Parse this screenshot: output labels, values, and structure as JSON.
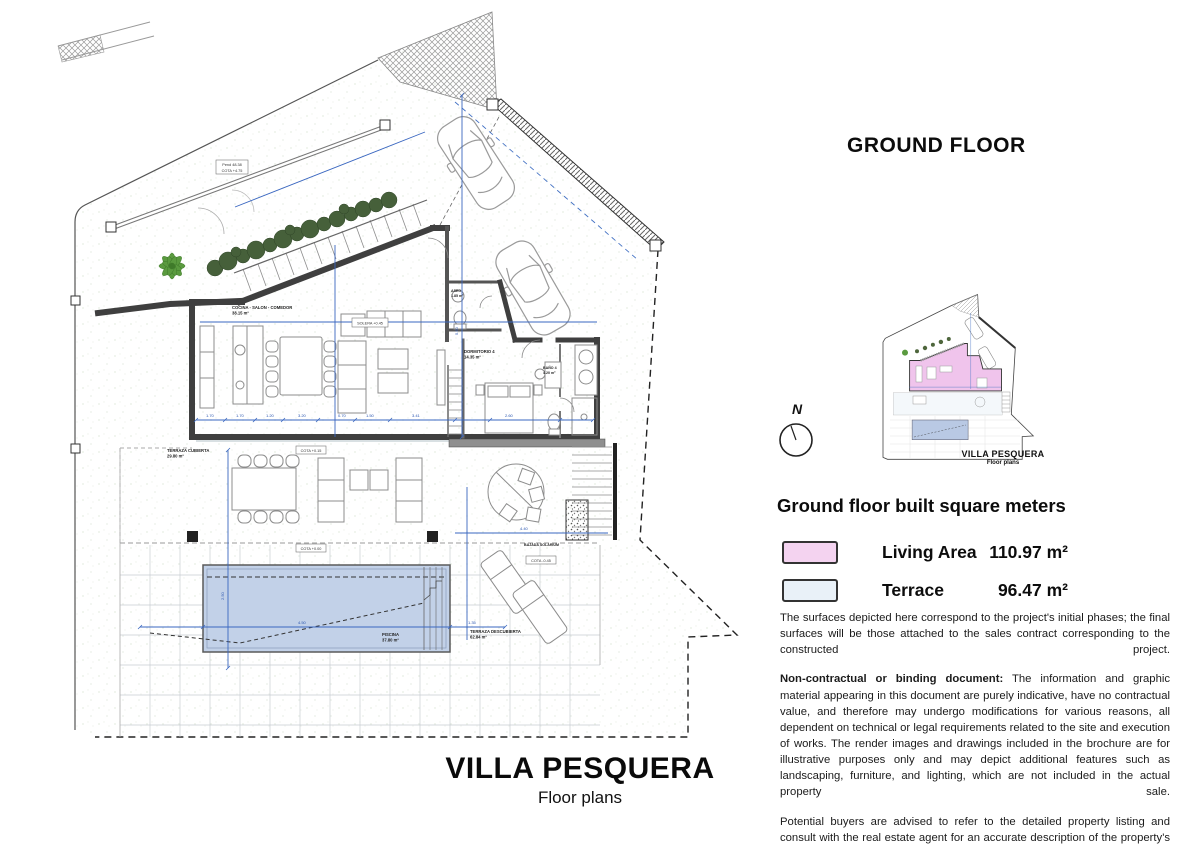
{
  "header": {
    "title": "GROUND FLOOR"
  },
  "inset": {
    "title": "VILLA PESQUERA",
    "subtitle": "Floor plans"
  },
  "compass": {
    "label": "N"
  },
  "legend": {
    "heading": "Ground floor built square meters",
    "items": [
      {
        "label": "Living Area",
        "value": "110.97 m²",
        "color": "#f4d3f0"
      },
      {
        "label": "Terrace",
        "value": "96.47 m²",
        "color": "#e9f1f8"
      }
    ]
  },
  "disclaimer": {
    "p1": "The surfaces depicted here correspond to the project's initial phases; the final surfaces will be those attached to the sales contract corresponding to the constructed project.",
    "p2_lead": "Non-contractual or binding document:",
    "p2_rest": " The information and graphic material appearing in this document are purely indicative, have no contractual value, and therefore may undergo modifications for various reasons, all dependent on technical or legal requirements related to the site and execution of works. The render images and drawings included in the brochure are for illustrative purposes only and may depict additional features such as landscaping, furniture, and lighting, which are not included in the actual property sale.",
    "p3": "Potential buyers are advised to refer to the detailed property listing and consult with the real estate agent for an accurate description of the property's features and inclusions. You may refer to the Decreto 218/2005 Junta de Andalucía, available at our offices."
  },
  "footer": {
    "title": "VILLA PESQUERA",
    "subtitle": "Floor plans"
  },
  "plan": {
    "rooms": {
      "kitchen_living": {
        "name": "COCINA - SALON - COMEDOR",
        "area": "38.15 m²"
      },
      "aseo": {
        "name": "ASEO",
        "area": "1.85 m²"
      },
      "bedroom": {
        "name": "DORMITORIO 4",
        "area": "14.35 m²"
      },
      "bath": {
        "name": "BAÑO 4",
        "area": "4.20 m²"
      },
      "covered_terrace": {
        "name": "TERRAZA CUBIERTA",
        "area": "29.80 m²"
      },
      "open_terrace": {
        "name": "TERRAZA DESCUBIERTA",
        "area": "62.84 m²"
      },
      "pool": {
        "name": "PISCINA",
        "area": "37.80 m²"
      },
      "stairs_down": {
        "name": "BAJADA SOLARIUM"
      }
    },
    "tags": {
      "t1": "COTA +0.15",
      "t2": "COTA +0.00",
      "t3": "COTA -0.45",
      "t4": "SOLERA +0.45",
      "t5": "Pend 48.38",
      "t6": "COTA +4.75"
    },
    "dims": [
      "1.70",
      "1.70",
      "1.20",
      "3.20",
      "0.70",
      "1.50",
      "3.41",
      "2.60",
      "5.60",
      "4.50",
      "1.35",
      "2.50",
      "4.40"
    ]
  }
}
